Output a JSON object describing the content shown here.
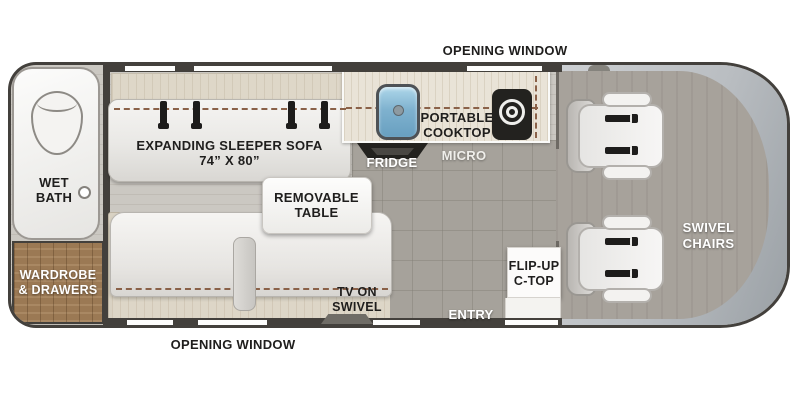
{
  "plan_name": "Camper van floor plan",
  "window_labels": {
    "top": "OPENING WINDOW",
    "bottom": "OPENING WINDOW"
  },
  "wet_bath": {
    "line1": "WET",
    "line2": "BATH"
  },
  "wardrobe": {
    "line1": "WARDROBE",
    "line2": "& DRAWERS"
  },
  "sleeper_sofa": {
    "line1": "EXPANDING SLEEPER SOFA",
    "line2": "74” X 80”"
  },
  "removable_table": {
    "line1": "REMOVABLE",
    "line2": "TABLE"
  },
  "portable_cooktop": {
    "line1": "PORTABLE",
    "line2": "COOKTOP"
  },
  "fridge": {
    "label": "FRIDGE"
  },
  "micro": {
    "label": "MICRO"
  },
  "tv": {
    "line1": "TV ON",
    "line2": "SWIVEL"
  },
  "flip_up_ctop": {
    "line1": "FLIP-UP",
    "line2": "C-TOP"
  },
  "entry": {
    "label": "ENTRY"
  },
  "swivel_chairs": {
    "line1": "SWIVEL",
    "line2": "CHAIRS"
  },
  "icons": {
    "toilet": "toilet-top-view",
    "sink": "sink-basin",
    "cooktop_burner": "burner-rings",
    "fridge": "fridge-top-view",
    "tv": "tv-on-swivel-top-view",
    "seat_belt": "seat-belt-strap",
    "swivel_seat": "seat-with-rotation-arrows"
  },
  "colors": {
    "outline_dark": "#43403c",
    "wood_brown": "#9b7954",
    "sink_blue": "#7fb2cf",
    "accent_green": "#8dc63f",
    "floor_gray": "#a6a29b"
  }
}
